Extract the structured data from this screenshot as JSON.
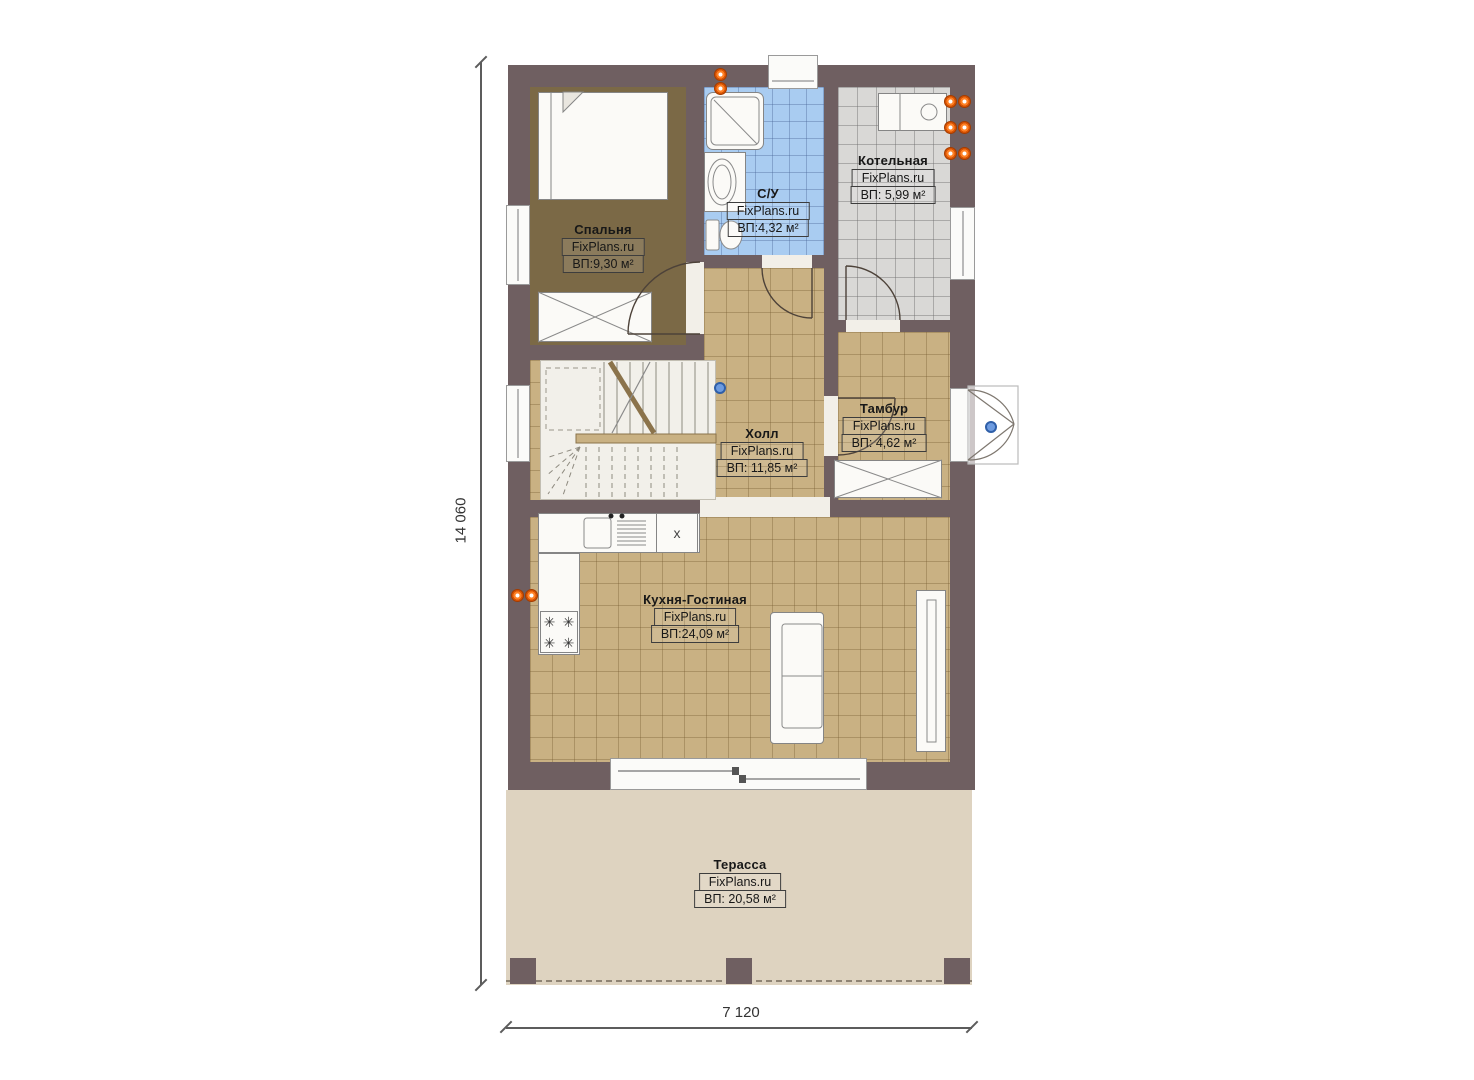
{
  "plan": {
    "title": "first-floor-plan",
    "dimensions": {
      "height_total": "14 060",
      "width_total": "7 120"
    },
    "rooms": [
      {
        "key": "bedroom",
        "name": "Спальня",
        "brand": "FixPlans.ru",
        "area": "ВП:9,30 м²"
      },
      {
        "key": "bathroom",
        "name": "С/У",
        "brand": "FixPlans.ru",
        "area": "ВП:4,32 м²"
      },
      {
        "key": "boiler",
        "name": "Котельная",
        "brand": "FixPlans.ru",
        "area": "ВП: 5,99 м²"
      },
      {
        "key": "hall",
        "name": "Холл",
        "brand": "FixPlans.ru",
        "area": "ВП: 11,85 м²"
      },
      {
        "key": "vestibule",
        "name": "Тамбур",
        "brand": "FixPlans.ru",
        "area": "ВП: 4,62 м²"
      },
      {
        "key": "kitchen_living",
        "name": "Кухня-Гостиная",
        "brand": "FixPlans.ru",
        "area": "ВП:24,09 м²"
      },
      {
        "key": "terrace",
        "name": "Терасса",
        "brand": "FixPlans.ru",
        "area": "ВП: 20,58 м²"
      }
    ],
    "labels": {
      "kitchen_unit": "x"
    },
    "icons": {
      "burner": "✳"
    },
    "colors": {
      "wall": "#6f5f61",
      "bedroom_floor": "#7b6946",
      "tile_floor": "#c9b183",
      "bathroom_floor": "#a9ccf1",
      "boiler_floor": "#d9d8d6",
      "terrace_floor": "#ded3c0",
      "vent_orange": "#ff8125",
      "marker_blue": "#6d9be0"
    }
  }
}
